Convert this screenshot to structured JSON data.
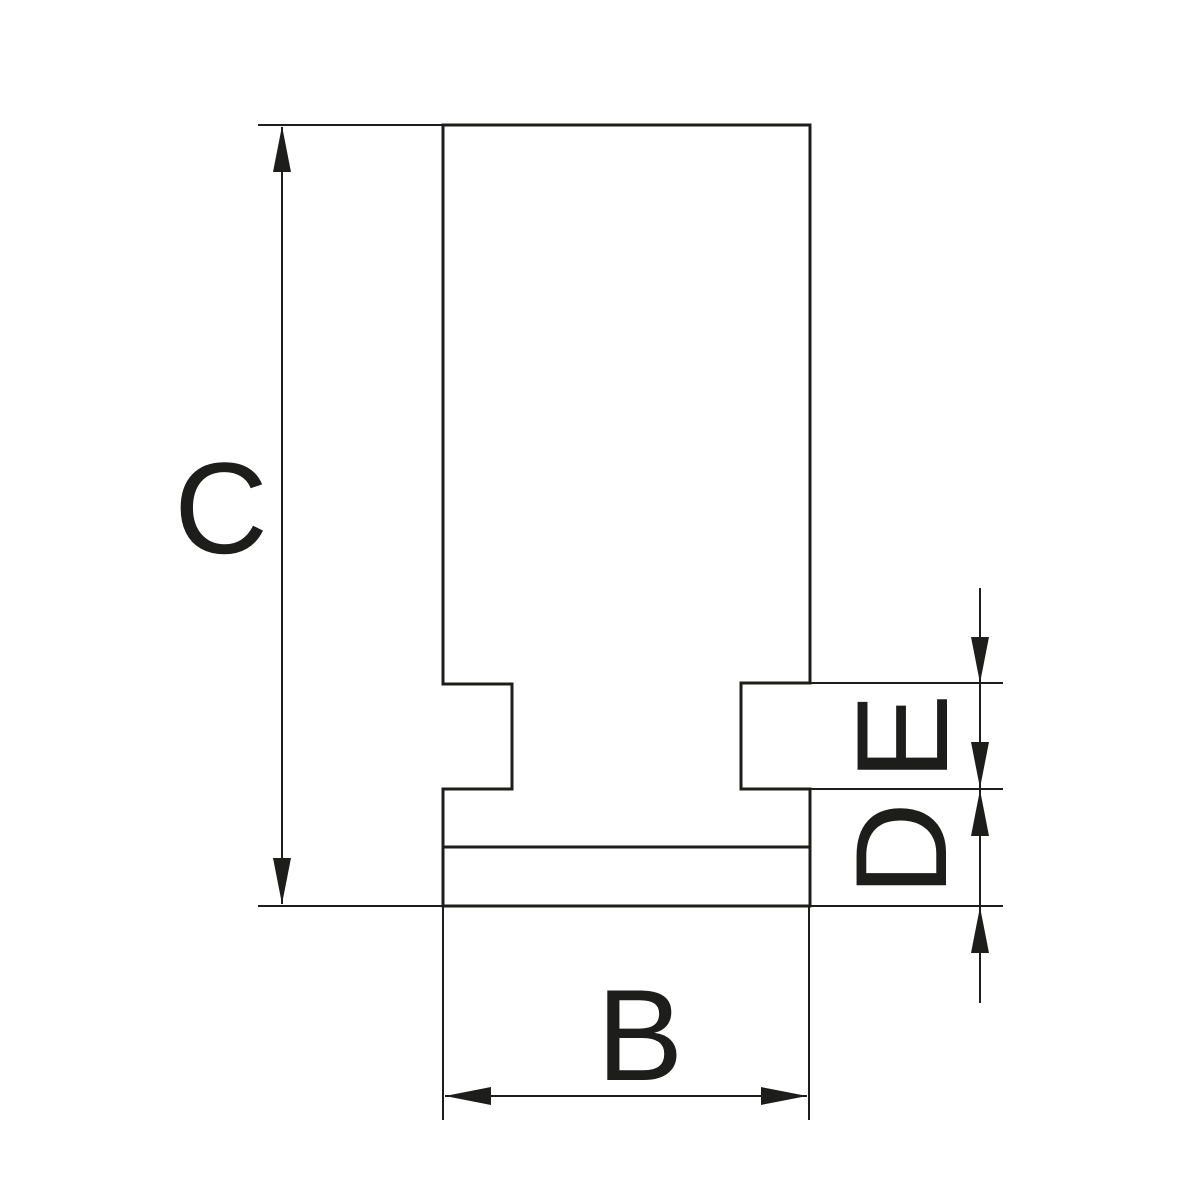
{
  "drawing": {
    "labels": {
      "c": "C",
      "b": "B",
      "d": "D",
      "e": "E"
    },
    "line_color": "#1d1d1b",
    "background_color": "#ffffff"
  }
}
